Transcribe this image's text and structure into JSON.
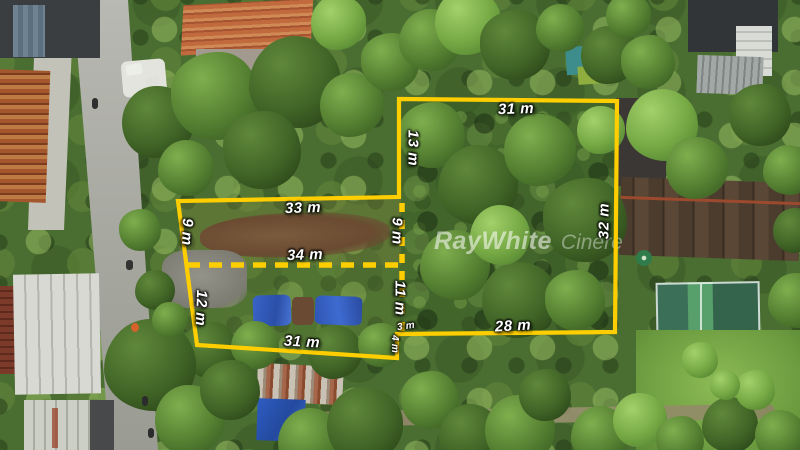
{
  "watermark": {
    "brand": "RayWhite",
    "office": "Cinere"
  },
  "parcel_right": {
    "top": "31 m",
    "left": "13 m",
    "right": "32 m",
    "bottom": "28 m"
  },
  "parcel_left": {
    "top": "33 m",
    "left_upper": "9 m",
    "left_lower": "12 m",
    "middle": "34 m",
    "right_upper": "9 m",
    "right_lower": "11 m",
    "bottom": "31 m"
  },
  "steps": {
    "horizontal": "3 m",
    "vertical": "4 m"
  },
  "colors": {
    "boundary_yellow": "#FFCE00",
    "label_text": "#FFFFFF"
  }
}
